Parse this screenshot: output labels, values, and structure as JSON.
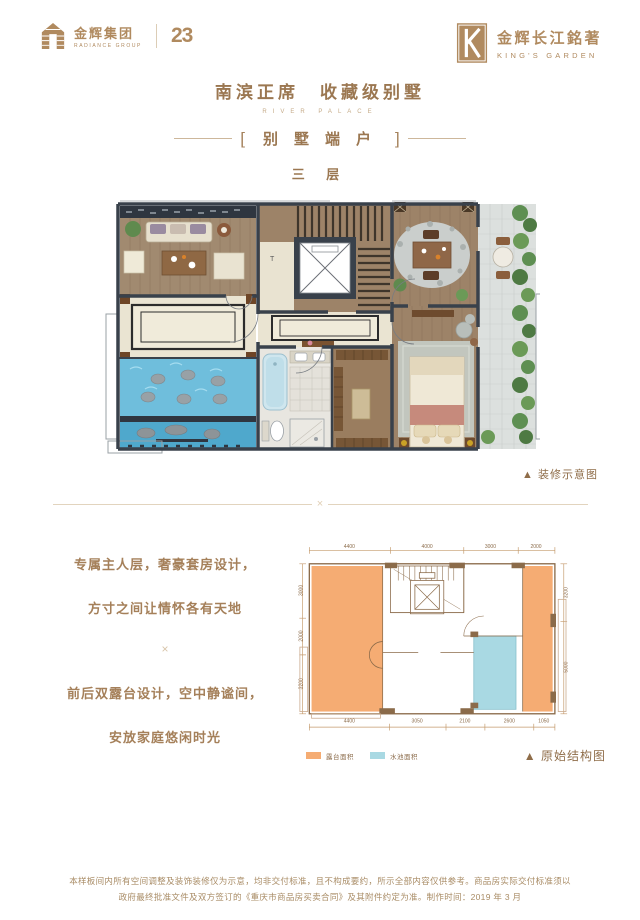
{
  "colors": {
    "gold": "#B08A5F",
    "bronze_title": "#9B7751",
    "bronze_text": "#A5805A",
    "divider": "#E2D4BE",
    "wall": "#39414B",
    "wood": "#9D8368",
    "pool_blue": "#64B9D8",
    "terrace_tile": "#DCE0DE",
    "plant_green": "#5E8F52",
    "struct_orange": "#F5AC73",
    "struct_blue": "#A9D9E3",
    "struct_line": "#8B6B4A"
  },
  "header": {
    "logo_left": {
      "name": "金辉集团",
      "en": "RADIANCE GROUP",
      "anniversary": "23"
    },
    "logo_right": {
      "name": "金辉长江銘著",
      "en": "KING'S GARDEN",
      "emblem": "K"
    }
  },
  "title": {
    "main": "南滨正席　收藏级别墅",
    "en": "RIVER PALACE",
    "bracket_open": "[",
    "bracket_text": "别墅端户",
    "bracket_close": "]",
    "floor": "三 层"
  },
  "renders": {
    "decorated_caption": "▲ 装修示意图",
    "structural_caption": "▲ 原始结构图"
  },
  "ornaments": {
    "x": "×"
  },
  "description": {
    "line1": "专属主人层，奢豪套房设计，",
    "line2": "方寸之间让情怀各有天地",
    "line3": "前后双露台设计，空中静谧间，",
    "line4": "安放家庭悠闲时光"
  },
  "structure": {
    "legend": [
      {
        "label": "露台面积",
        "color": "#F5AC73"
      },
      {
        "label": "水池面积",
        "color": "#A9D9E3"
      }
    ],
    "dims": {
      "top": [
        "4400",
        "4000",
        "3000",
        "2000"
      ],
      "bottom": [
        "4400",
        "3050",
        "2100",
        "2600",
        "1050"
      ],
      "left": [
        "3000",
        "2000",
        "3200"
      ],
      "right": [
        "3200",
        "5000"
      ]
    }
  },
  "footer": {
    "line1": "本样板间内所有空间调整及装饰装修仅为示意，均非交付标准，且不构成要约，所示全部内容仅供参考。商品房实际交付标准须以",
    "line2": "政府最终批准文件及双方签订的《重庆市商品房买卖合同》及其附件约定为准。制作时间：2019 年 3 月"
  }
}
